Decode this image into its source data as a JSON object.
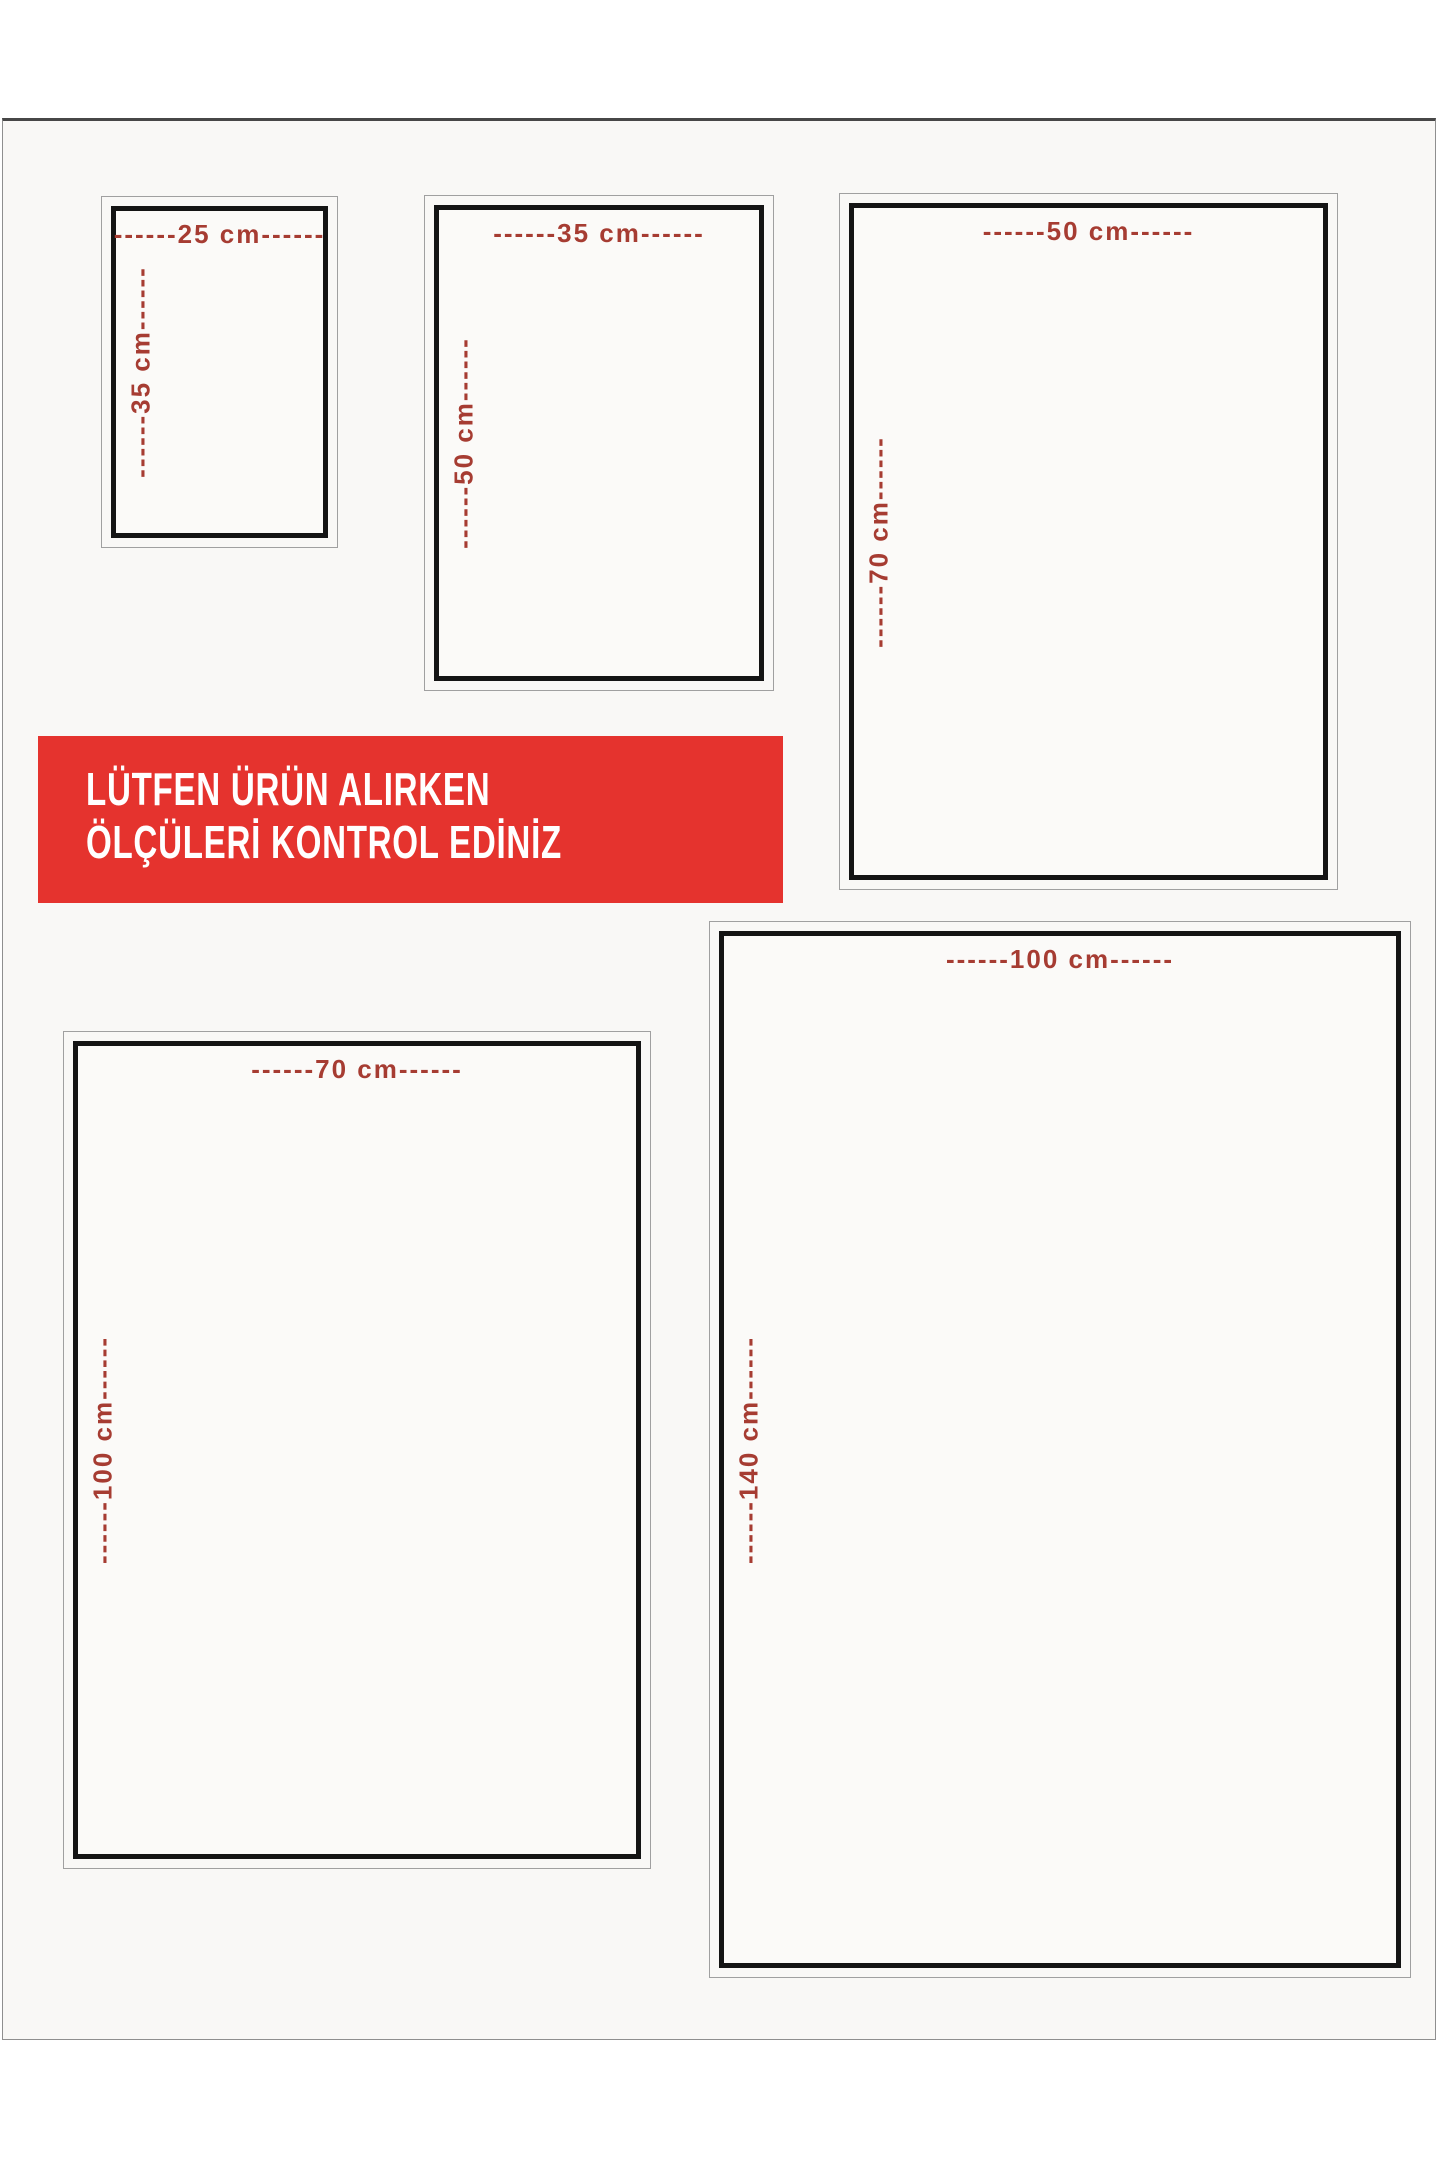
{
  "colors": {
    "page_bg": "#ffffff",
    "canvas_bg": "#f9f8f6",
    "box_bg": "#fbfaf8",
    "frame_gray": "#8f8f8f",
    "frame_dark": "#474747",
    "border_gray": "#a0a0a0",
    "border_black": "#141414",
    "label_red": "#a63c32",
    "banner_red": "#e5332e",
    "banner_text": "#ffffff"
  },
  "notice_banner": {
    "line1": "LÜTFEN ÜRÜN ALIRKEN",
    "line2": "ÖLÇÜLERİ KONTROL EDİNİZ"
  },
  "size_boxes": [
    {
      "name": "25x35",
      "width_cm": 25,
      "height_cm": 35,
      "width_label": "------25 cm------",
      "height_label": "------35 cm------"
    },
    {
      "name": "35x50",
      "width_cm": 35,
      "height_cm": 50,
      "width_label": "------35 cm------",
      "height_label": "------50 cm------"
    },
    {
      "name": "50x70",
      "width_cm": 50,
      "height_cm": 70,
      "width_label": "------50 cm------",
      "height_label": "------70 cm------"
    },
    {
      "name": "70x100",
      "width_cm": 70,
      "height_cm": 100,
      "width_label": "------70 cm------",
      "height_label": "------100 cm------"
    },
    {
      "name": "100x140",
      "width_cm": 100,
      "height_cm": 140,
      "width_label": "------100 cm------",
      "height_label": "------140 cm------"
    }
  ]
}
